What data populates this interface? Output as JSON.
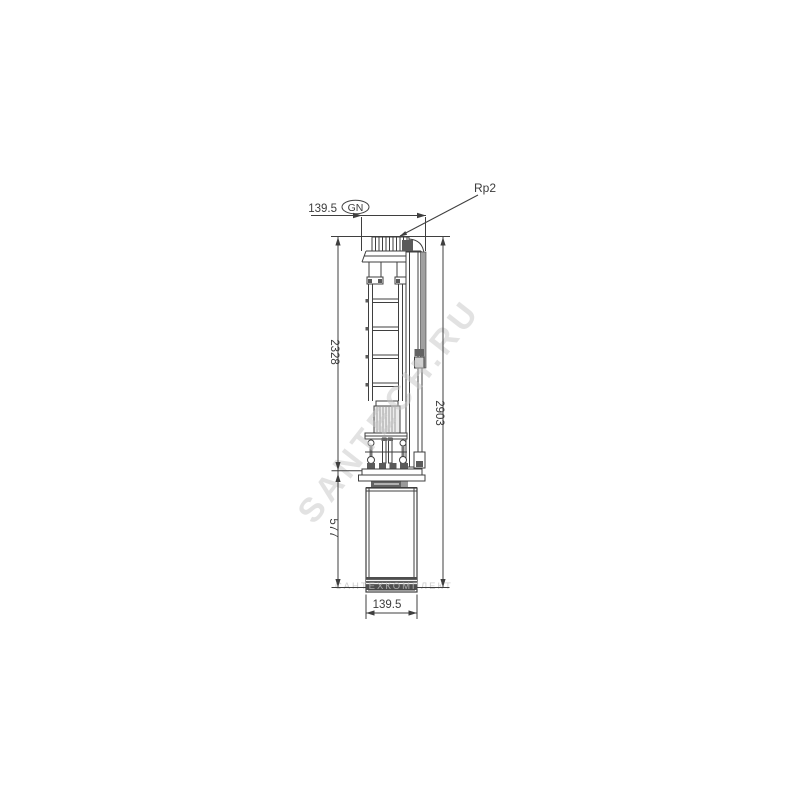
{
  "page": {
    "background": "#ffffff"
  },
  "drawing": {
    "subject": "submersible-pump-dimensional-drawing",
    "dimensions": {
      "top_width": "139.5",
      "top_width_note": "GN",
      "discharge_connection": "Rp2",
      "pump_section_length": "2328",
      "motor_section_length": "577",
      "total_length": "2903",
      "bottom_width": "139.5"
    },
    "watermarks": {
      "main": "SANTECH.RU",
      "secondary": "САНТЕХКОМПЛЕКТ"
    },
    "colors": {
      "line": "#3f3f3f",
      "dark_fill": "#5a5a5a",
      "watermark_main": "#c7c7c7",
      "watermark_secondary": "#c2c2c2"
    }
  }
}
